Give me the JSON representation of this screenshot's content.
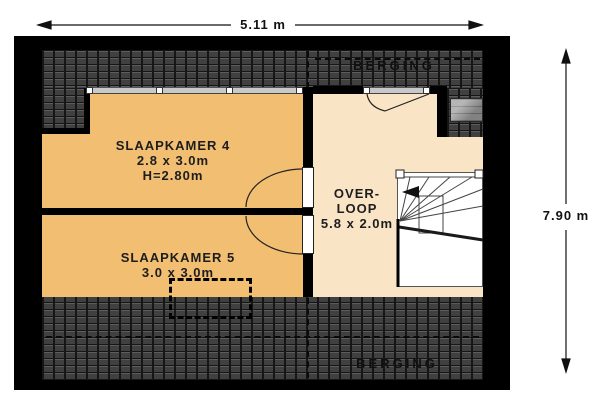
{
  "title": "floor-plan-attic",
  "dimensions": {
    "width_label": "5.11 m",
    "height_label": "7.90 m"
  },
  "rooms": {
    "slaapkamer4": {
      "name": "SLAAPKAMER 4",
      "size": "2.8 x 3.0m",
      "ceiling": "H=2.80m"
    },
    "slaapkamer5": {
      "name": "SLAAPKAMER 5",
      "size": "3.0 x 3.0m"
    },
    "overloop": {
      "name_line1": "OVER-",
      "name_line2": "LOOP",
      "size": "5.8 x 2.0m"
    },
    "berging_top": {
      "name": "BERGING"
    },
    "berging_bottom": {
      "name": "BERGING"
    }
  },
  "colors": {
    "room_fill": "#f2be71",
    "hall_fill": "#fae4c6",
    "roof_base": "#474747",
    "roof_grout": "#161616",
    "wall": "#000000",
    "window_band": "#c9c9c9",
    "skylight": "#9e9e9e"
  }
}
